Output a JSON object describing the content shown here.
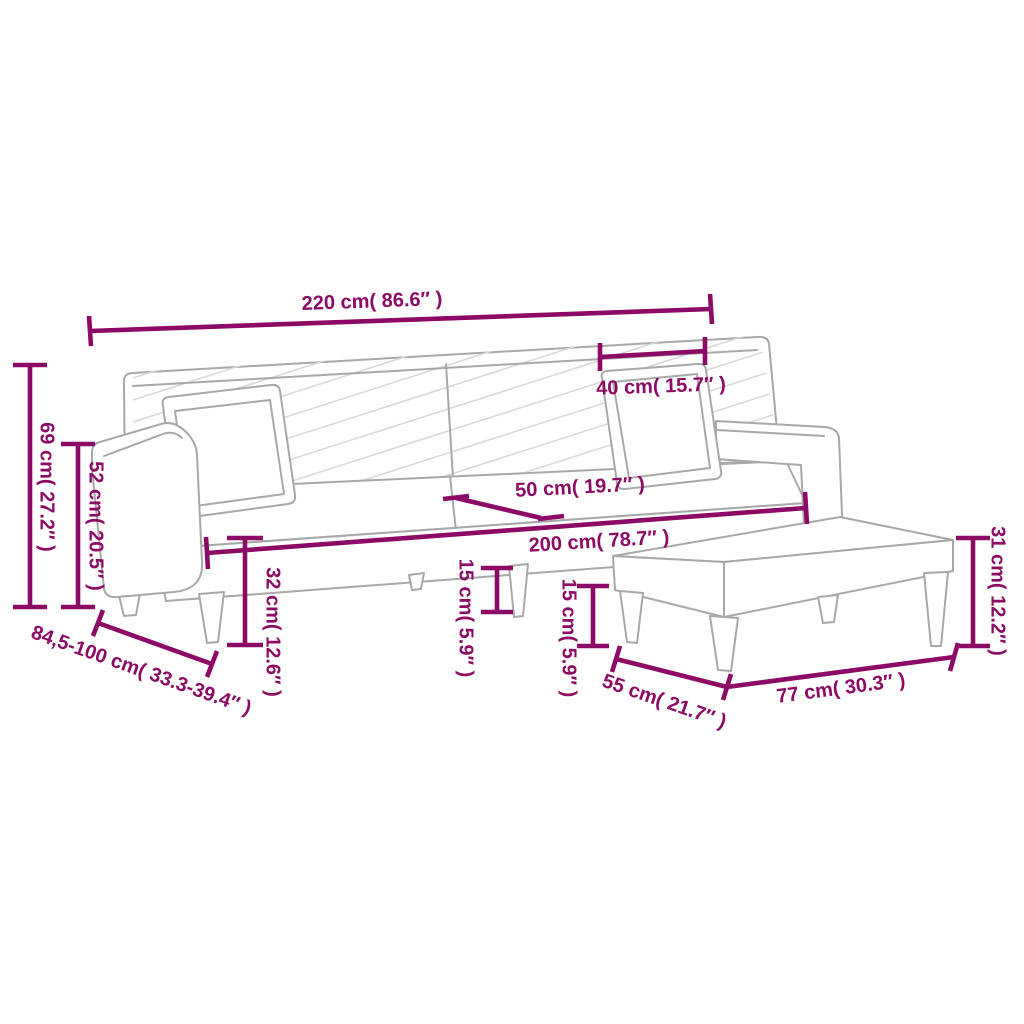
{
  "diagram": {
    "kind": "furniture-dimension-diagram",
    "accent_color": "#8C0966",
    "sketch_color": "#A8A8A8",
    "background_color": "#FFFFFF"
  },
  "dims": [
    {
      "name": "sofa-width",
      "label": "220 cm( 86.6″ )"
    },
    {
      "name": "pillow-width",
      "label": "40 cm( 15.7″ )"
    },
    {
      "name": "total-height",
      "label": "69 cm( 27.2″ )"
    },
    {
      "name": "armrest-height",
      "label": "52 cm( 20.5″ )"
    },
    {
      "name": "depth-range",
      "label": "84,5-100 cm( 33.3-39.4″ )"
    },
    {
      "name": "seat-depth",
      "label": "50 cm( 19.7″ )"
    },
    {
      "name": "seat-width",
      "label": "200 cm( 78.7″ )"
    },
    {
      "name": "seat-height",
      "label": "32 cm( 12.6″ )"
    },
    {
      "name": "sofa-leg-clearance",
      "label": "15 cm( 5.9″ )"
    },
    {
      "name": "footstool-leg-clearance",
      "label": "15 cm( 5.9″ )"
    },
    {
      "name": "footstool-height",
      "label": "31 cm( 12.2″ )"
    },
    {
      "name": "footstool-depth",
      "label": "55 cm( 21.7″ )"
    },
    {
      "name": "footstool-width",
      "label": "77 cm( 30.3″ )"
    }
  ]
}
